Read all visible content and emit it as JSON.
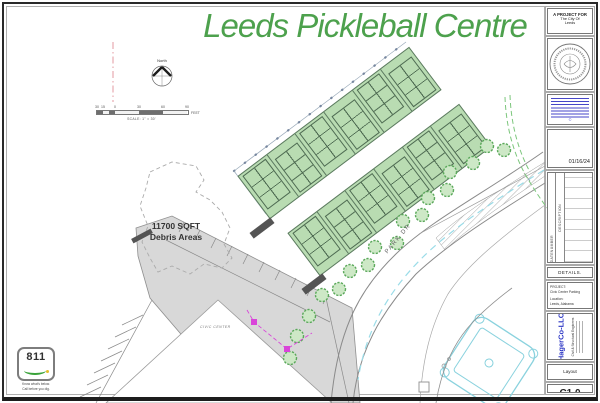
{
  "sheet": {
    "title": "Leeds Pickleball Centre"
  },
  "map": {
    "north_label": "North",
    "scale": {
      "ticks": [
        "30",
        "15",
        "0",
        "30",
        "60",
        "90"
      ],
      "unit": "FEET",
      "caption": "SCALE: 1\" = 30'"
    },
    "debris_label": [
      "11700 SQFT",
      "Debris Areas"
    ],
    "road_label": "PARK DR",
    "building_label": "CIVIC CENTER",
    "court_count": 12
  },
  "logo811": {
    "number": "811",
    "tagline": [
      "Know what's below.",
      "Call before you dig."
    ]
  },
  "titleblock": {
    "project_for": [
      "A PROJECT FOR",
      "The City Of",
      "Leeds"
    ],
    "disclaimer_mark": "©",
    "date": "01/16/24",
    "revision_table": {
      "col_description": "DESCRIPTION",
      "col_number": "NUMBER",
      "col_date": "DATE"
    },
    "details_label": "DETAILS.",
    "project": {
      "label": "PROJECT:",
      "name": "Civic Center Parking",
      "location_label": "Location:",
      "location": "Leeds, Alabama"
    },
    "firm": {
      "name": "HagerCo-LLC",
      "subtitle": "Civil & Structural Engineers"
    },
    "sheet_title": "Layout",
    "sheet_number": "C1.0",
    "sheet_of": "Sheet 1 Of xx"
  },
  "colors": {
    "title_green": "#4da14d",
    "court_green": "#b9dcb2",
    "tree_green": "#5aa85a",
    "road_gray": "#8a8a8a",
    "field_cyan": "#8ad2de",
    "utility_magenta": "#d944d9",
    "firm_blue": "#2b35c4"
  }
}
